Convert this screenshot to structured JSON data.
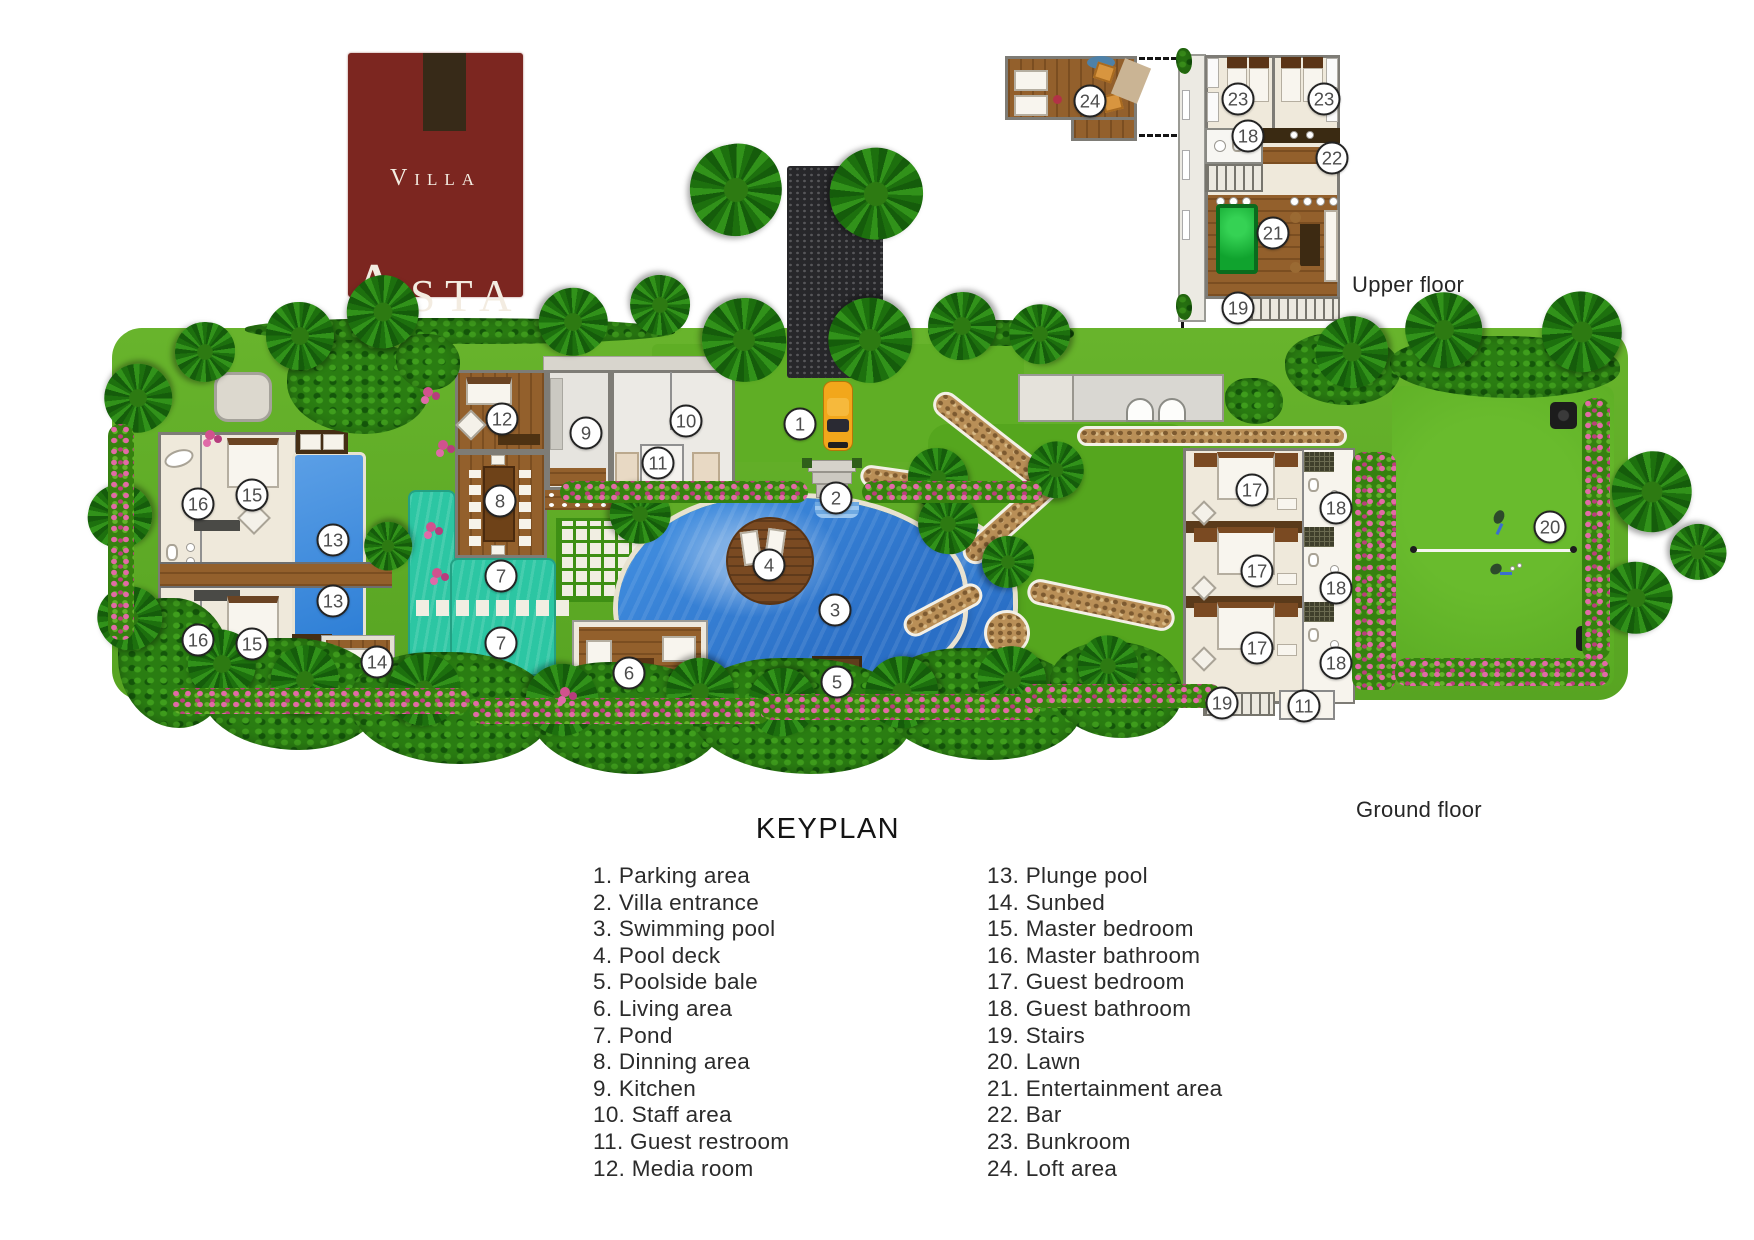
{
  "logo": {
    "line1": "Villa",
    "line2": "Asta"
  },
  "labels": {
    "upper_floor": "Upper floor",
    "ground_floor": "Ground floor"
  },
  "keyplan": {
    "title": "KEYPLAN",
    "items_left": [
      {
        "n": 1,
        "label": "Parking area"
      },
      {
        "n": 2,
        "label": "Villa entrance"
      },
      {
        "n": 3,
        "label": "Swimming pool"
      },
      {
        "n": 4,
        "label": "Pool deck"
      },
      {
        "n": 5,
        "label": "Poolside bale"
      },
      {
        "n": 6,
        "label": "Living area"
      },
      {
        "n": 7,
        "label": "Pond"
      },
      {
        "n": 8,
        "label": "Dinning area"
      },
      {
        "n": 9,
        "label": "Kitchen"
      },
      {
        "n": 10,
        "label": "Staff area"
      },
      {
        "n": 11,
        "label": "Guest restroom"
      },
      {
        "n": 12,
        "label": "Media room"
      }
    ],
    "items_right": [
      {
        "n": 13,
        "label": "Plunge pool"
      },
      {
        "n": 14,
        "label": "Sunbed"
      },
      {
        "n": 15,
        "label": "Master bedroom"
      },
      {
        "n": 16,
        "label": "Master bathroom"
      },
      {
        "n": 17,
        "label": "Guest bedroom"
      },
      {
        "n": 18,
        "label": "Guest bathroom"
      },
      {
        "n": 19,
        "label": "Stairs"
      },
      {
        "n": 20,
        "label": "Lawn"
      },
      {
        "n": 21,
        "label": "Entertainment area"
      },
      {
        "n": 22,
        "label": "Bar"
      },
      {
        "n": 23,
        "label": "Bunkroom"
      },
      {
        "n": 24,
        "label": "Loft area"
      }
    ]
  },
  "markers": {
    "upper": [
      {
        "n": 24,
        "x": 1090,
        "y": 101
      },
      {
        "n": 23,
        "x": 1238,
        "y": 99
      },
      {
        "n": 23,
        "x": 1324,
        "y": 99
      },
      {
        "n": 18,
        "x": 1248,
        "y": 136
      },
      {
        "n": 22,
        "x": 1332,
        "y": 158
      },
      {
        "n": 21,
        "x": 1273,
        "y": 233
      },
      {
        "n": 19,
        "x": 1238,
        "y": 308
      }
    ],
    "ground": [
      {
        "n": 1,
        "x": 800,
        "y": 424
      },
      {
        "n": 2,
        "x": 836,
        "y": 498
      },
      {
        "n": 3,
        "x": 835,
        "y": 610
      },
      {
        "n": 4,
        "x": 769,
        "y": 565
      },
      {
        "n": 5,
        "x": 837,
        "y": 682
      },
      {
        "n": 6,
        "x": 629,
        "y": 673
      },
      {
        "n": 7,
        "x": 501,
        "y": 576
      },
      {
        "n": 7,
        "x": 501,
        "y": 643
      },
      {
        "n": 8,
        "x": 500,
        "y": 501
      },
      {
        "n": 9,
        "x": 586,
        "y": 433
      },
      {
        "n": 10,
        "x": 686,
        "y": 421
      },
      {
        "n": 11,
        "x": 658,
        "y": 463
      },
      {
        "n": 11,
        "x": 1304,
        "y": 706
      },
      {
        "n": 12,
        "x": 502,
        "y": 419
      },
      {
        "n": 13,
        "x": 333,
        "y": 540
      },
      {
        "n": 13,
        "x": 333,
        "y": 601
      },
      {
        "n": 14,
        "x": 377,
        "y": 662
      },
      {
        "n": 15,
        "x": 252,
        "y": 495
      },
      {
        "n": 15,
        "x": 252,
        "y": 644
      },
      {
        "n": 16,
        "x": 198,
        "y": 504
      },
      {
        "n": 16,
        "x": 198,
        "y": 640
      },
      {
        "n": 17,
        "x": 1252,
        "y": 490
      },
      {
        "n": 17,
        "x": 1257,
        "y": 571
      },
      {
        "n": 17,
        "x": 1257,
        "y": 648
      },
      {
        "n": 18,
        "x": 1336,
        "y": 508
      },
      {
        "n": 18,
        "x": 1336,
        "y": 588
      },
      {
        "n": 18,
        "x": 1336,
        "y": 663
      },
      {
        "n": 19,
        "x": 1222,
        "y": 703
      },
      {
        "n": 20,
        "x": 1550,
        "y": 527
      }
    ]
  },
  "colors": {
    "logo_bg": "#7c2620",
    "logo_tab": "#372a18",
    "pool_blue": "#2f80d8",
    "pond_teal": "#2cc6a3",
    "plunge_blue": "#2e7fd6",
    "wood_brown": "#93602c",
    "lawn_green": "#63ad28",
    "marker_border": "#232323"
  }
}
